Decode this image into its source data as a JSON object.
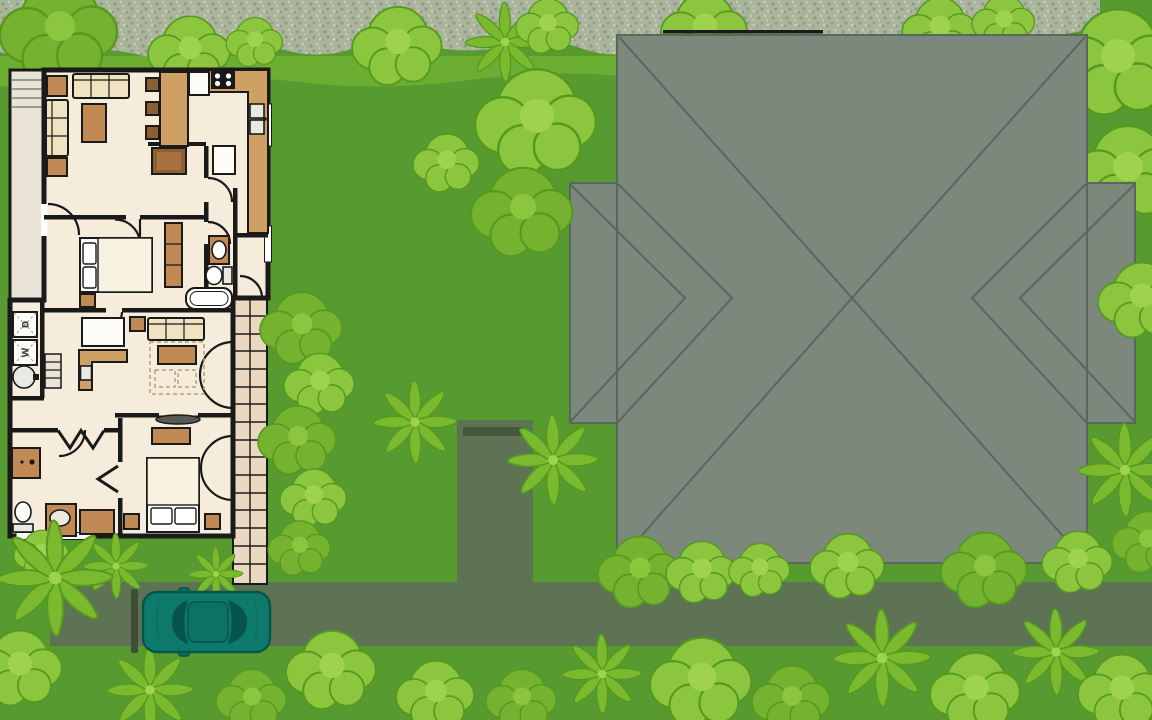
{
  "scene": {
    "appliance_labels": {
      "dryer": "D",
      "washer": "W"
    }
  },
  "colors": {
    "grass": "#579A2F",
    "grass-light": "#6CAE32",
    "gravel": "#ABB49C",
    "gravel-dot-dark": "#8E9B84",
    "gravel-dot-light": "#C7CEB9",
    "road": "#5E7354",
    "road-step": "#47573F",
    "post": "#3E4C38",
    "roof": "#7C887C",
    "roof-ridge": "#5A675C",
    "wall": "#1A1A1A",
    "floor": "#F5ECDB",
    "porch": "#EAE4D6",
    "walkway": "#EAD9C0",
    "wood": "#C18A54",
    "wood-dark": "#8B5E34",
    "counter": "#CFA063",
    "cream": "#EFE3C1",
    "white": "#FDFCF7",
    "fixture": "#E9E9E3",
    "tree-light": "#8CC63E",
    "tree-mid": "#74B22F",
    "tree-palm": "#7BB92F",
    "tree-inner": "#9ED24F",
    "tree-outline": "#55991F",
    "car-body": "#0D7A6C",
    "car-glass": "#07544A",
    "car-roof": "#0C7264",
    "car-outline": "#06564C",
    "tv": "#555A57"
  }
}
